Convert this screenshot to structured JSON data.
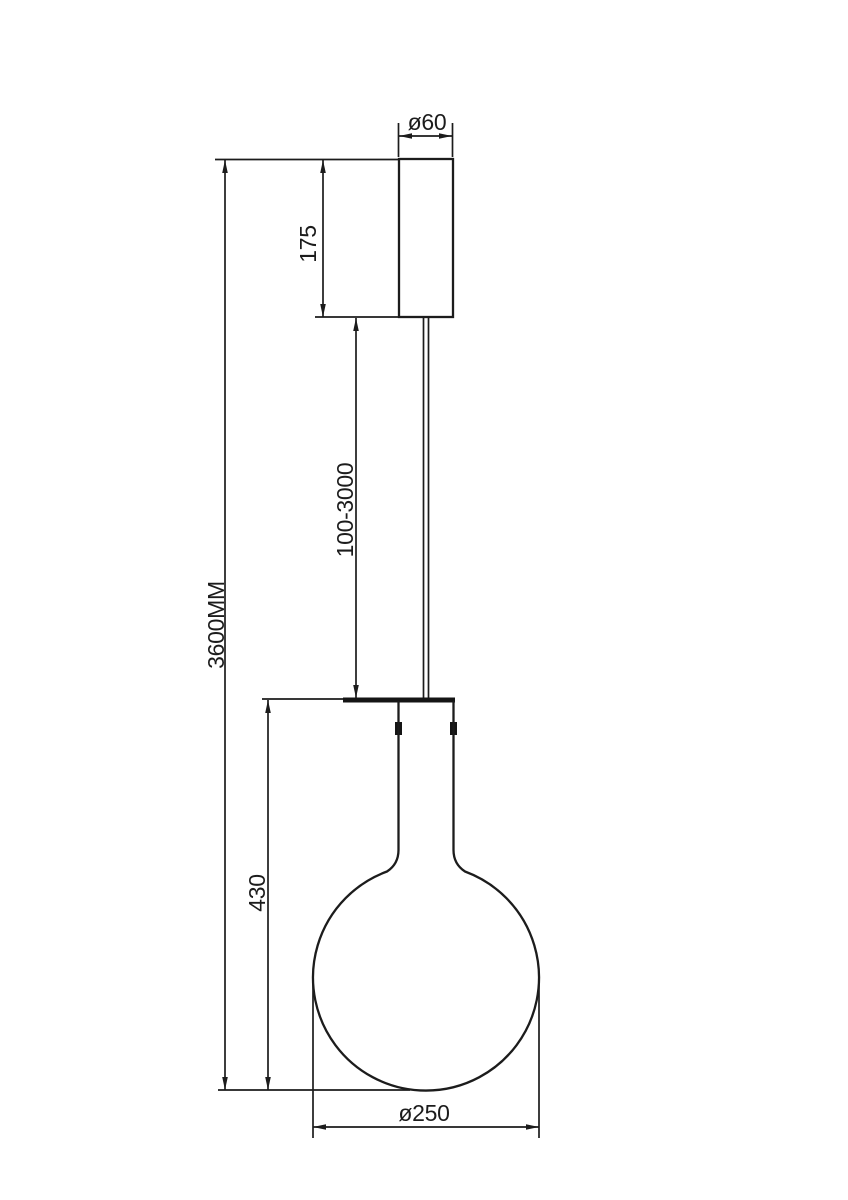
{
  "page": {
    "background_color": "#ffffff",
    "line_color": "#1c1c1c"
  },
  "drawing": {
    "type": "technical-dimension-diagram",
    "subject": "pendant-lamp-side-view",
    "parts": [
      {
        "id": "canopy",
        "description": "ceiling canopy cylinder"
      },
      {
        "id": "suspension-cable",
        "description": "double-line hanging cable"
      },
      {
        "id": "socket-plate",
        "description": "lamp holder top plate"
      },
      {
        "id": "glass-globe",
        "description": "globe bulb with cylindrical neck"
      }
    ],
    "dimensions": [
      {
        "id": "canopy-diameter",
        "label": "ø60",
        "orientation": "horizontal"
      },
      {
        "id": "canopy-height",
        "label": "175",
        "orientation": "vertical"
      },
      {
        "id": "cable-length",
        "label": "100-3000",
        "orientation": "vertical"
      },
      {
        "id": "overall-height",
        "label": "3600MM",
        "orientation": "vertical"
      },
      {
        "id": "globe-assembly-height",
        "label": "430",
        "orientation": "vertical"
      },
      {
        "id": "globe-diameter",
        "label": "ø250",
        "orientation": "vertical"
      }
    ]
  }
}
